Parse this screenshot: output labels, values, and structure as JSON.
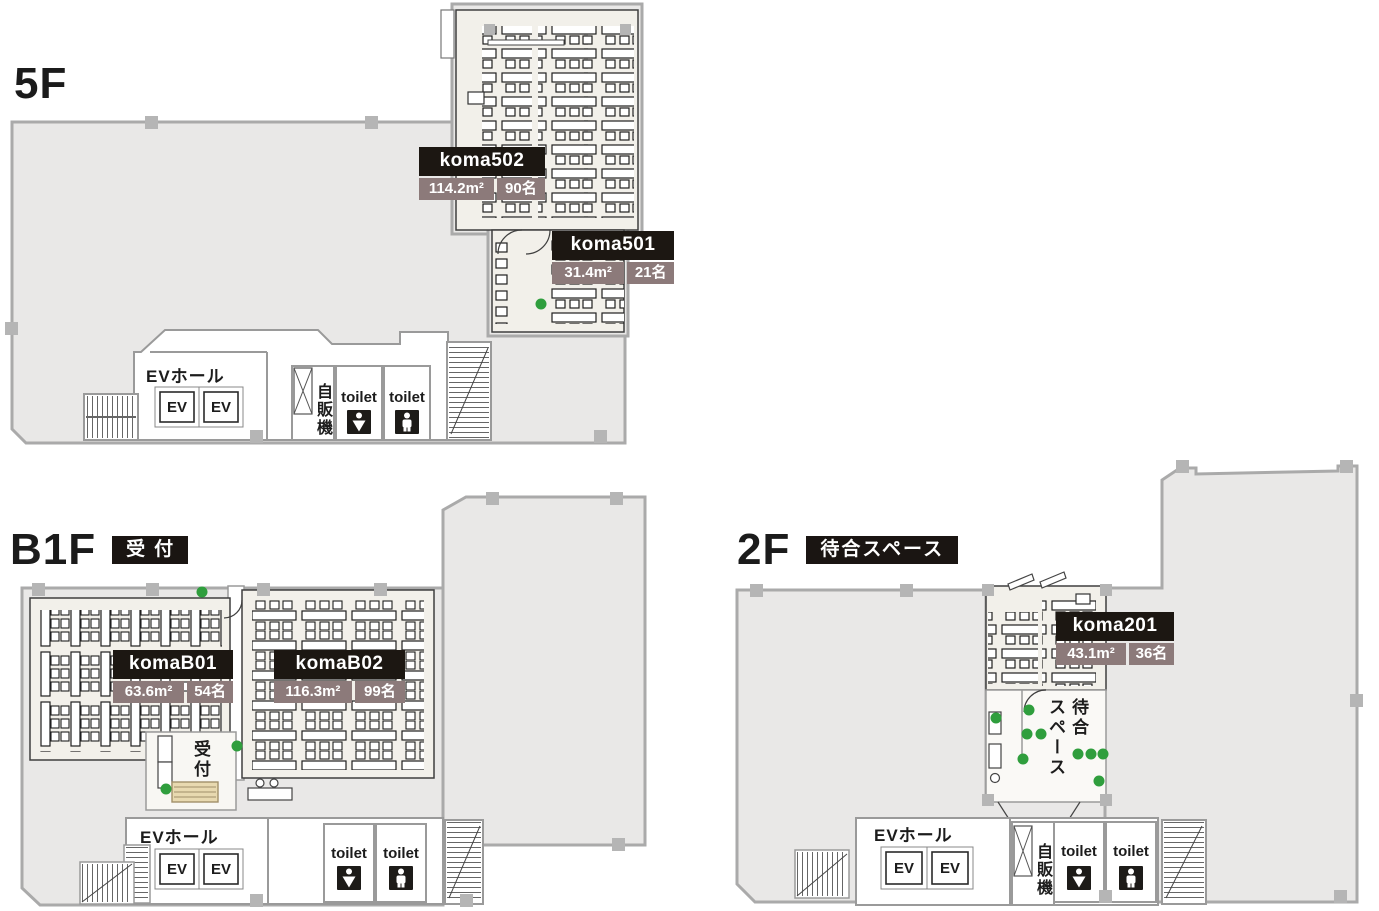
{
  "palette": {
    "floor_fill": "#e9e8e7",
    "wall_gray": "#a9a9a9",
    "partition_gray": "#9a9a9a",
    "room_fill": "#f2f0ea",
    "label_header_bg": "#1c1712",
    "label_sub_bg": "#8c7a7a",
    "accent_green": "#2f9e3d",
    "reception_desk_tan": "#e8d9b0",
    "icon_black": "#1d1b18"
  },
  "floors": {
    "f5": {
      "title": "5F",
      "rooms": [
        {
          "name": "koma502",
          "area": "114.2m²",
          "capacity": "90名"
        },
        {
          "name": "koma501",
          "area": "31.4m²",
          "capacity": "21名"
        }
      ],
      "facilities": {
        "ev_hall": "EVホール",
        "ev": "EV",
        "vending": "自販機",
        "toilet": "toilet"
      }
    },
    "b1f": {
      "title": "B1F",
      "badge": "受付",
      "rooms": [
        {
          "name": "komaB01",
          "area": "63.6m²",
          "capacity": "54名"
        },
        {
          "name": "komaB02",
          "area": "116.3m²",
          "capacity": "99名"
        }
      ],
      "facilities": {
        "ev_hall": "EVホール",
        "ev": "EV",
        "toilet": "toilet",
        "reception": "受付"
      }
    },
    "f2": {
      "title": "2F",
      "badge": "待合スペース",
      "rooms": [
        {
          "name": "koma201",
          "area": "43.1m²",
          "capacity": "36名"
        }
      ],
      "facilities": {
        "ev_hall": "EVホール",
        "ev": "EV",
        "vending": "自販機",
        "toilet": "toilet",
        "waiting_space": "待合\nスペース"
      }
    }
  }
}
